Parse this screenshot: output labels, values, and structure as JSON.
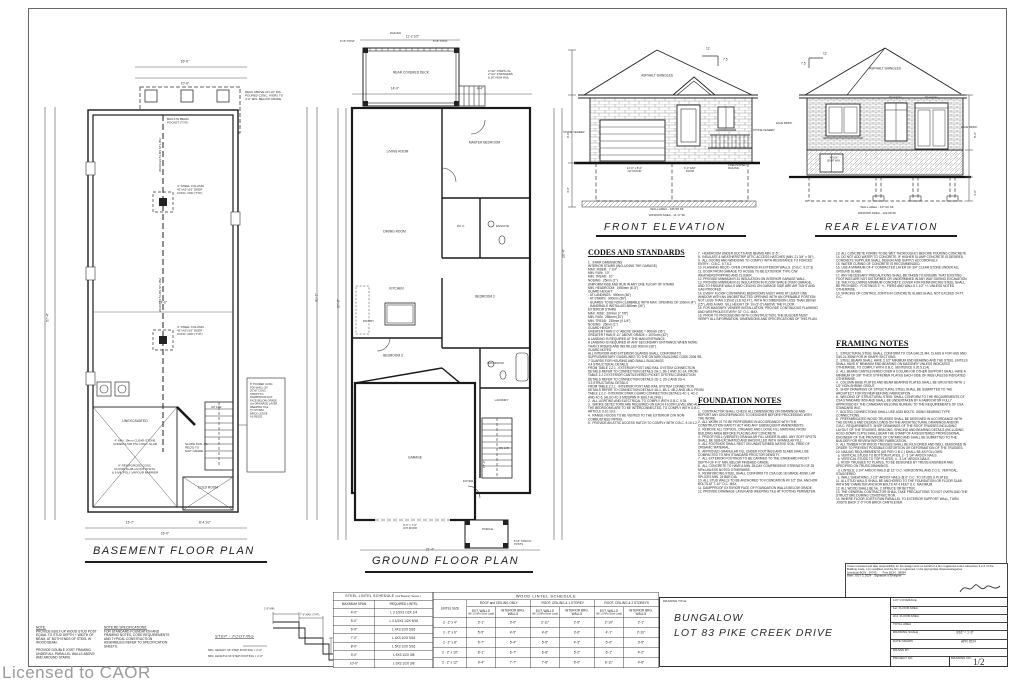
{
  "sheet": {
    "licensed_to": "Licensed to CAOR"
  },
  "basement": {
    "title": "BASEMENT FLOOR PLAN",
    "labels": {
      "unexcavated": "UNEXCAVATED",
      "stone_note": "4\" MIN. 19mm CLEAR STONE\nUNDER 3,500 PSI CONC. SLAB",
      "slab_note": "4\" REINFORCED CONC.\nFLOOR SLAB c/w 6x6 W.W.M.\n& 6 MIL POLY VAPOUR BARRIER",
      "slope_note": "SLOPE FDN. AS\nREQ'D TO\nSUIT GRADE",
      "cold_room": "COLD ROOM",
      "column_note1": "4\" STEEL COLUMN\n42\"x42\"x16\" DEEP\nCONC. PAD (TYP.)",
      "column_note2": "4\" STEEL COLUMN\n42\"x42\"x16\" DEEP\nCONC. PAD (TYP.)",
      "beam_label1": "W310X22.5 LBS STL BM",
      "beam_label2": "W310X22.5 LBS STL BM",
      "pocket_note": "BUILT-IN BEAM\nPOCKET (TYP.)",
      "porch_note": "DECK ABOVE ON 10\" DIA.\nPOURED CONC. PIERS TO\n4'-0\" MIN. BELOW GRADE",
      "up_label": "UP 14R",
      "side_note": "8\" POURED CONC.\nFDN WALL ON\n20\"x8\" CONC.\nSTRIP FTG.\nDAMPPROOF EXT.\nFACE BELOW GRADE\nc/w DRAINAGE LAYER.\nWEEPING TILE\nTO STORM.\nBRICK LEDGE\nAS REQ'D."
    },
    "dims": {
      "left": "57'-4\"",
      "right": "31'-1\"",
      "top": "16'-0\"",
      "porch": "10'-0\"",
      "mid": "14'-0\"",
      "b1": "15'-7\"",
      "b2": "8'-4 1/2\"",
      "b3": "16'-0\""
    }
  },
  "ground": {
    "title": "GROUND FLOOR PLAN",
    "labels": {
      "deck": "REAR COVERED DECK",
      "post": "6\"x6\" POST",
      "railing": "RAILING",
      "steps": "2\"x10\" STEPS c/w\n2\"x10\" STRINGERS\n& 36\" HIGH RAIL",
      "living": "LIVING ROOM",
      "master": "MASTER BEDROOM",
      "dining": "DINING ROOM",
      "wic": "W.I.C.",
      "ensuite": "ENSUITE",
      "kitchen": "KITCHEN",
      "pantry": "PANTRY",
      "bed2": "BEDROOM 2",
      "bed3": "BEDROOM 3",
      "bath": "BATHROOM",
      "laundry": "LAUNDRY",
      "garage": "GARAGE",
      "foyer": "FOYER",
      "porch": "PORCH",
      "dn": "DN 14R",
      "garage_door": "9'-0\" x 7'-0\"\nO/H DOOR",
      "struct_post": "6\"x6\" STRUCT.\nPOSTS"
    },
    "dims": {
      "deck": "11'-2 1/2\"",
      "top1": "14'-0\"",
      "top2": "4'-4\"",
      "left": "37'-0\"",
      "right": "20'-4\"",
      "bottom": "21'-4\"",
      "garage": "17'-4\""
    }
  },
  "front_elev": {
    "title": "FRONT ELEVATION",
    "shingles": "ASPHALT SHINGLES",
    "stone_l": "STONE VENEER",
    "stone_r": "STONE VENEER",
    "pitch_run": "12",
    "pitch_rise": "7.5",
    "garage_door": "12'-0\" x 8'-0\"\nO/H DOOR",
    "ent_door": "3'-0\" ENT.\nDOOR",
    "railing": "PREFINISHED\nRAILING",
    "wall_area": "WALL AREA - 345.58 SF",
    "window_area": "WINDOW AREA - 11.17 SF",
    "dims": {
      "h1": "9'-0\"",
      "h2": "4'-0\""
    }
  },
  "rear_elev": {
    "title": "REAR ELEVATION",
    "shingles": "ASPHALT SHINGLES",
    "cladding_l": "FACE BRICK",
    "cladding_r": "FACE BRICK",
    "pitch_run": "12",
    "pitch_rise": "7.5",
    "transom1": "TRANSOM",
    "transom2": "TRANSOM",
    "bsmt_win": "48\"x24\"\nBSMT WIN.",
    "wall_area": "WALL AREA - 417.00 SF",
    "window_area": "WINDOW AREA - 129.08 SF",
    "dims": {
      "h1": "8'-0\"",
      "h2": "4'-0\""
    }
  },
  "notes": {
    "codes_title": "CODES AND STANDARDS",
    "codes_col1": "1.  STAIR DIMENSIONS\nINTERIOR STAIRS (INCLUDING THE GARAGE)\nMAX. RISER:  7 1/4\"\nMIN. RUN:  10\"\nMIN. TREAD:  10\"\nNOSING:  25mm (1\")\nUNIFORM RISE AND RUN IN ANY ONE FLIGHT OF STAIRS\nMIN. HEADROOM:  1950mm (6'-5\")\nGUARD HEIGHT:\n- AT LANDINGS:  900mm (36\")\n- AT STAIRS:  900mm (36\")\n- GUARDS TO BE NON-CLIMBABLE WITH MAX. OPENING OF 100mm (4\")\n- HANDRAILS INSTALLED 865mm (34\")\nEXTERIOR STAIRS\nMAX. RISE:  200mm (7 7/8\")\nMIN. RUN:  255mm (10\")\nMIN. TREAD:  235mm (9 1/4\")\nNOSING:  25mm (1\")\nGUARD HEIGHT:\nGREATER THAN 2'-0\" ABOVE GRADE = 900mm (36\")\nGREATER THAN 5'-11\" ABOVE GRADE = 1070mm (42\")\nA LANDING IS REQUIRED AT THE MAIN ENTRANCE.\nA LANDING IS REQUIRED AT ANY SECONDARY ENTRANCE WHEN MORE THAN 3 RISERS AND INSTALLED 900mm (36\").\nGUARD NOTES:\nALL INTERIOR AND EXTERIOR GUARDS SHALL CONFORM TO SUPPLEMENTARY GUIDELINES TO THE ONTARIO BUILDING CODE 2006 SB-7 GUARDS FOR HOUSING AND SMALL BUILDINGS.\n4.4 STRUCTURAL DETAILS\nFROM TABLE 2.2.1 - EXTERIOR POST AND RAIL SYSTEM CONNECTION DETAILS REFER TO CONNECTION DETAILS 2A-1, 2B-1 AND 2C-1A. FROM TABLE 2.2.2 EXTERIOR CANTILEVERED PICKET SYSTEM CONNECTION DETAILS REFER TO CONNECTION DETAILS 2D-1, 2D-2 AND 2D-4.\n3.3 STRUCTURAL DETAILS\nFROM TABLE 2.2.1 - INTERIOR POST AND RAIL SYSTEM CONNECTION DETAILS REFER TO CONNECTION DETAILS 4A-1, 4B-1, 4B-2 AND 4B-4. FROM TABLE 2.2.2 - INTERIOR STAIR GUARD CONNECTION DETAILS 4C-1, 4C-2 AND 4C-6. (ALSO 4C-3 MIDSPAN IF BUILT ALONG.)\n2.  ALL LIGHTING AND ELECTRICAL TO COMPLY WITH O.B.C. 9.34.\n3.  SMOKE DETECTORS ARE REQUIRED ON EACH FLOOR LEVEL AND ALL THE BEDROOMS ARE TO BE INTERCONNECTED, TO COMPLY WITH O.B.C. ARTICLE 9.10.19.3.\n4.  RANGE HOODS TO BE VENTED TO THE EXTERIOR C/W NON-COMBUSTIBLE PIPING.\n5.  PROVIDE AN ATTIC ACCESS HATCH TO COMPLY WITH O.B.C. 9.19.1.2.",
    "codes_col2": "7.  HEADROOM UNDER DUCTS AND BEAMS MIN. 6'-5\".\n8.  INSULATE & WEATHERSTRIP ATTIC ACCESS HATCHES (MIN. 21 3/4\" x 35\").\n9.  ALL DOORS AND WINDOWS TO COMPLY WITH RESISTANCE TO FORCED ENTRY - O.B.C. 9.7.5.2.\n10. FLASHING REQ'D. OVER OPENINGS IN EXTERIOR WALLS. (O.B.C. 9.27.3)\n11. DOOR FROM GARAGE TO HOUSE TO BE EXTERIOR TYPE C/W WEATHERSTRIPPING AND CLOSER.\n12. PROVIDE MINIMUM R-31 INSULATION ON INTERIOR GARAGE WALL.\n13. PROVIDE MINIMUM R-31 INSULATION IN FLOOR SPACE OVER GARAGE, AND TO ENSURE WALLS AND CEILING ON GARAGE SIDE ARE AIR TIGHT AND GAS PROOFED.\n14. EVERY FLOOR CONTAINING BEDROOMS MUST HAVE AT LEAST ONE WINDOW WITH AN UNOBSTRUCTED OPENING WITH AN OPENABLE PORTION NOT LESS THAN 0.35m2 (3.8 SQ.FT.), WITH NO DIMENSION LESS THAN 380mm (15\"), AND A MAX. SILL HEIGHT OF 1m (3'-3\") ABOVE THE FLOOR.\n15. FOR MASONRY VENEER INSTALLATION, PROVIDE CONTINUOUS FLASHING AND WEEPHOLES EVERY 32\" O.C. MAX.\n16. PRIOR TO PROCEEDING WITH CONSTRUCTION, THE BUILDER MUST VERIFY ALL INFORMATION, DIMENSIONS AND SPECIFICATIONS OF THIS PLAN.",
    "foundation_title": "FOUNDATION NOTES",
    "foundation_col2": "1.  CONTRACTOR SHALL CHECK ALL DIMENSIONS ON DRAWINGS AND REPORT ANY DISCREPANCIES TO DESIGNER BEFORE PROCEEDING WITH THE WORK.\n2.  ALL WORK IS TO BE PERFORMED IN ACCORDANCE WITH THE CONSTRUCTION SAFETY ACT AND ANY SUBSEQUENT AMENDMENTS.\n3.  REMOVE ALL TOPSOIL, ORGANIC AND LOOSE FILL MATERIAL FROM BUILDING AREA BEFORE PLACING ANY CONCRETE.\n4.  PROOF ROLL (VIBRATE) GRANULAR FILL UNDER SLABS. ANY SOFT SPOTS SHALL BE SUB-EXCAVATED AND BACKFILLED WITH GRANULAR FILL.\n5.  ALL FOOTINGS SHALL REST ON UNDISTURBED NATIVE SOIL, FREE OF ORGANIC MATERIAL.\n6.  APPROVED GRANULAR FILL UNDER FOOTINGS AND SLABS SHALL BE COMPACTED TO 98% STANDARD PROCTOR DENSITY.\n7.  ALL EXTERIOR FOOTINGS TO BE CARRIED TO THE STANDARD FROST DEPTH OF 4'-0\" MIN. BELOW FINISHED GRADE.\n8.  ALL CONCRETE TO HAVE A MIN. 28-DAY COMPRESSIVE STRENGTH OF 25 MPa UNLESS NOTED OTHERWISE.\n9.  REINFORCING STEEL SHALL CONFORM TO CSA G30.18 GRADE 400W. LAP SPLICES MIN. 24 BAR DIA.\n10. ALL STUD WALLS TO BE ANCHORED TO FOUNDATION W/ 1/2\" DIA. ANCHOR BOLTS AT 7'-10\" O.C. MAX.\n11. DAMPPROOF EXTERIOR FACE OF FOUNDATION WALLS BELOW GRADE.\n12. PROVIDE DRAINAGE LAYER AND WEEPING TILE AT FOOTING PERIMETER.",
    "foundation_col3": "13. ALL CONCRETE FORMS TO BE WET THOROUGHLY BEFORE POURING CONCRETE.\n14. DO NOT ADD WATER TO CONCRETE. IF HIGHER SLUMP CONCRETE IS DESIRED, CONCRETE SUPPLIER SHALL DESIGN AND SUPPLY ACCORDINGLY.\n15. WATER CURING OF CONCRETE IS RECOMMENDED.\n16. USE A MINIMUM OF 4\" COMPACTED LAYER OF 3/4\" CLEAR STONE UNDER ALL GROUND SLABS.\n17. ANY NECESSARY PRECAUTIONS SHALL BE TAKEN TO ENSURE THAT EXISTING FOOTINGS ARE NOT DISTURBED OR UNDERMINED IN ANY WAY DURING EXCAVATION.\n18. THE FOLLOWING MINIMUM CONCRETE COVER FOR REINFORCING STEEL SHALL BE PROVIDED - FOOTINGS 3\" +/-, PIERS AND WALLS 1 1/2\" +/- UNLESS NOTED OTHERWISE.\n19. SPACING OF CONTROL JOINTS IN CONCRETE SLABS SHALL NOT EXCEED 24 FT. O.C.",
    "framing_title": "FRAMING NOTES",
    "framing_body": "1.  STRUCTURAL STEEL SHALL CONFORM TO CSA G40.21-M4, CLASS H FOR HSS AND G40.21-350W FOR W SHAPE SECTIONS.\n2.  STEEL BEAMS SHALL HAVE 3 1/2\" MINIMUM END BEARING AND THE STEEL LINTELS SHALL HAVE 6\" MINIMUM END BEARING ON MASONRY UNLESS INDICATED OTHERWISE, TO COMPLY WITH O.B.C. SENTENCE 9.20.5.2.(4).\n3.  ALL BEAMS CANTILEVERED OVER A COLUMN OR OTHER SUPPORT SHALL HAVE A MINIMUM OF 3/8\" THICK STIFFENER PLATES EACH SIDE OF WEB UNLESS INDICATED OTHERWISE.\n4.  COLUMN BASE PLATES AND BEAM BEARING PLATES SHALL BE GROUTED WITH 1 1/2\" NON-SHRINK GROUT.\n5.  SHOP DRAWINGS OF STRUCTURAL STEEL SHALL BE SUBMITTED TO THE ARCHITECT FOR REVIEW BEFORE FABRICATION.\n6.  WELDING OF STRUCTURAL STEEL SHALL CONFORM TO THE REQUIREMENTS OF CSA STANDARD W59 AND SHALL BE UNDERTAKEN BY A FABRICATOR FULLY APPROVED BY THE CANADIAN WELDING BUREAU TO THE REQUIREMENTS OF CSA STANDARD W47.\n7.  BOLTED CONNECTIONS SHALL USE A325 BOLTS, USING BEARING TYPE CONNECTIONS.\n8.  PREFABRICATED WOOD TRUSSES SHALL BE DESIGNED IN ACCORDANCE WITH THE DETAILS AND DESIGN LOADS ON THE ARCHITECTURAL DRAWINGS AND/OR O.B.C. REQUIREMENTS. SHOP DRAWINGS OF THE ROOF TRUSSES INCLUDING LAYOUT OF THE TRUSSES, BRACING, SPACING AND BEARING DETAILS (INCLUDING HOLD-DOWN CLIPS) SHALL BEAR THE STAMP OF A REGISTERED PROFESSIONAL ENGINEER OF THE PROVINCE OF ONTARIO AND SHALL BE SUBMITTED TO THE BUILDER FOR REVIEW BEFORE FABRICATION.\n9.  ALL TIMBER FOR WOOD TRUSSES SHALL BE KILN DRIED AND WELL SEASONED IN ORDER TO PREVENT POSSIBLE DISTORTION OR DEFORMATION OF THE TRUSSES.\n10. NAILING REQUIREMENTS (AS PER O.B.C.) SHALL BE AS FOLLOWS:\n  a. VERTICAL STUDS TO BOTTOM PLATES, 2 - 3 1/4\" ARDOX NAILS.\n  b. VERTICAL STUDS TO TOP PLATES, 4 - 3 1/4\" ARDOX NAILS.\n  c. ROOF TRUSSES TO PLATES, TO BE DESIGNED BY TRUSS ENGINEER AND SPECIFIED ON TRUSS DRAWINGS.\n  d. LINTELS, 3 1/4\" ARDOX NAILS @ 12\" O.C. HORIZONTAL AND 2 O.C. VERTICAL, STAGGERED.\n  e. WALL SHEATHING, 2 1/2\" ARDOX NAILS @ 6\" O.C. TO STUDS & PLATES.\n11. ALL STUD WALLS SHALL BE ANCHORED TO THE FOUNDATION OR FLOOR SLAB WITH 5/8\" DIAMETER ANCHOR BOLTS AT 4 FEET O.C. MAXIMUM.\n12. ALL WOOD SHALL BE No. 2 SPRUCE OR BETTER.\n13. THE GENERAL CONTRACTOR SHALL TAKE PRECAUTIONS TO NOT OVERLOAD THE STRUCTURE DURING CONSTRUCTION.\n14. WHERE FLOOR JOISTS RUN PARALLEL TO EXTERIOR SUPPORT WALL, TURN JOISTS BACK 2'-0\" FOR BRICK CANTILEVER."
  },
  "bottom_notes": {
    "note_heading": "NOTE:",
    "note_body": "PROVIDE BUILT-UP WOOD STUD POST EQUAL TO STUD DEPTH + WIDTH OF BEAM, AT BOTH ENDS OF STEEL W WOOD BEAM.\n\nPROVIDE DOUBLE JOIST FRAMING UNDER ALL PARALLEL WALLS ABOVE AND AROUND STAIRS.",
    "spec_heading": "NOTE RE SPECIFICATIONS:",
    "spec_body": "FOR STANDARD FOUNDATION AND FRAMING NOTES, CODE REQUIREMENTS AND TYPICAL CONSTRUCTION ASSEMBLIES REFER TO SPECIFICATION SHEETS."
  },
  "step_footing": {
    "title": "STEP - FOOTING",
    "note1": "MIN. HEIGHT OF STEP FOOTING = 2'-0\"",
    "note2": "MIN. LENGTH OF STEP FOOTING = 2'-0\"",
    "dim1": "2'-0\" MIN.",
    "dim2": "7'-0\" MAX. (TYP.)"
  },
  "steel_table": {
    "title": "STEEL LINTEL SCHEDULE",
    "subtitle": "( For Masonry Veneer )",
    "col_span": "MAXIMUM SPAN",
    "col_lintel": "REQUIRED LINTEL",
    "rows": [
      {
        "span": "4'-0\"",
        "lintel": "L 3 1/2X3 1/2X 1/4"
      },
      {
        "span": "5'-0\"",
        "lintel": "L 3 1/2X3 1/2X 5/16"
      },
      {
        "span": "6'-0\"",
        "lintel": "L 4X3 1/2X 5/16"
      },
      {
        "span": "7'-0\"",
        "lintel": "L 4X3 1/2X 5/16"
      },
      {
        "span": "8'-0\"",
        "lintel": "L 5X3 1/2X 5/16"
      },
      {
        "span": "9'-0\"",
        "lintel": "L 5X3 1/2X 3/8"
      },
      {
        "span": "10'-0\"",
        "lintel": "L 6X3 1/2X 3/8"
      }
    ]
  },
  "wood_table": {
    "title": "WOOD LINTEL SCHEDULE",
    "col_size": "LINTEL SIZE",
    "group1": "ROOF and CEILING ONLY",
    "group2": "ROOF, CEILING & 1 STOREY",
    "group3": "ROOF, CEILING & 2 STOREYS",
    "sub_ext": "EXT. WALLS",
    "sub_ext_note": "(W/ 1.0 kPa Snow Load)",
    "sub_int": "INTERIOR BRG. WALLS",
    "rows": [
      {
        "size": "2 - 2\" x 4\"",
        "c1": "3'-1\"",
        "c2": "3'-0\"",
        "c3": "2'-11\"",
        "c4": "2'-5\"",
        "c5": "2'-10\"",
        "c6": "2'-1\""
      },
      {
        "size": "2 - 2\" x 6\"",
        "c1": "5'-5\"",
        "c2": "4'-5\"",
        "c3": "4'-6\"",
        "c4": "3'-6\"",
        "c5": "4'-1\"",
        "c6": "2'-10\""
      },
      {
        "size": "2 - 2\" x 8\"",
        "c1": "6'-7\"",
        "c2": "5'-4\"",
        "c3": "5'-5\"",
        "c4": "4'-3\"",
        "c5": "5'-0\"",
        "c6": "3'-5\""
      },
      {
        "size": "2 - 2\" x 10\"",
        "c1": "8'-1\"",
        "c2": "6'-7\"",
        "c3": "6'-8\"",
        "c4": "5'-2\"",
        "c5": "6'-1\"",
        "c6": "4'-2\""
      },
      {
        "size": "2 - 2\" x 12\"",
        "c1": "9'-4\"",
        "c2": "7'-7\"",
        "c3": "7'-8\"",
        "c4": "6'-0\"",
        "c5": "6'-11\"",
        "c6": "4'-8\""
      }
    ]
  },
  "title_block": {
    "label": "DRAWING TITLE",
    "line1": "BUNGALOW",
    "line2": "LOT 83 PIKE CREEK DRIVE",
    "row_lot": "LOT COVERAGE",
    "row_f1": "1st. FLOOR AREA",
    "row_f2": "2nd. FLOOR AREA",
    "row_total": "TOTAL AREA",
    "row_scale": "DRAWING SCALE",
    "scale_value": "3/16\" = 1'-0\"",
    "row_date": "DATE DRAWN",
    "date_value": "APR 2024",
    "row_drawn": "DRAWN BY",
    "row_project": "PROJECT NO.",
    "row_dwgno": "DRAWING NO.",
    "dwgno_value": "1/2"
  },
  "stamp": {
    "para": "I have reviewed and take responsibility for the design work on behalf of a firm registered under subsection 3.2.4. of the Building Code. I am qualified, and the firm is registered, in the appropriate classes/categories.",
    "bcin": "Individual BCIN : 34745        Firm BCIN : 38994",
    "date_line": "Date: JULY 3, 2024    Signature of Designer:"
  }
}
